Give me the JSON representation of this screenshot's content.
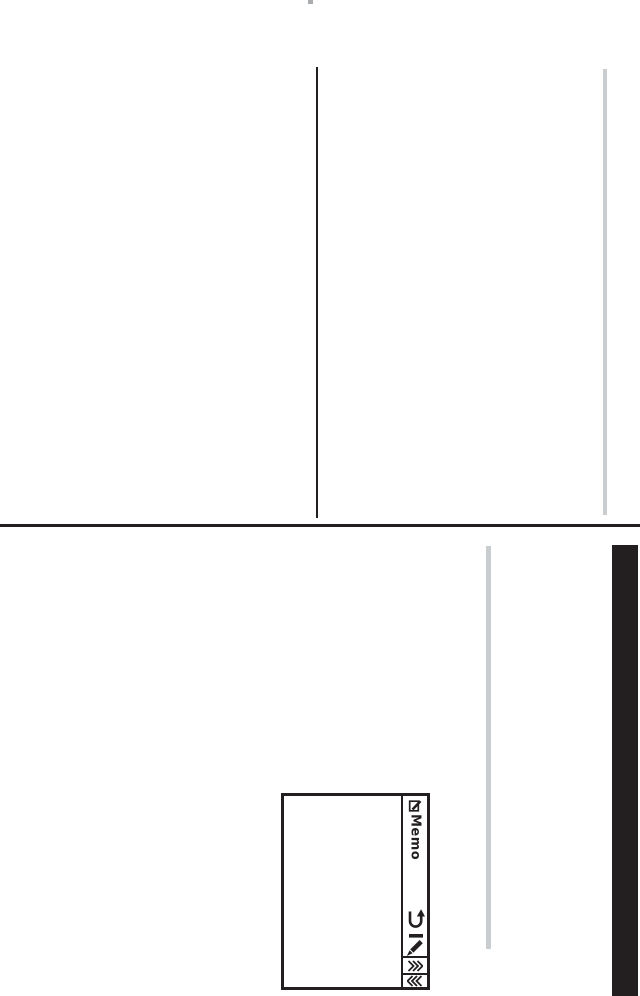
{
  "page": {
    "background": "#ffffff"
  },
  "colors": {
    "ink": "#231f20",
    "edge_gray": "#c9cdd0",
    "tick_gray": "#a9adb0",
    "page_bg": "#ffffff"
  },
  "figure": {
    "toolbar_title": "Memo",
    "icons": {
      "memo": "memo-note-pencil-icon",
      "undo": "undo-arrow-icon",
      "pencil": "pencil-edit-icon",
      "page_forward": "double-chevron-forward-icon",
      "page_back": "double-chevron-back-icon"
    }
  }
}
